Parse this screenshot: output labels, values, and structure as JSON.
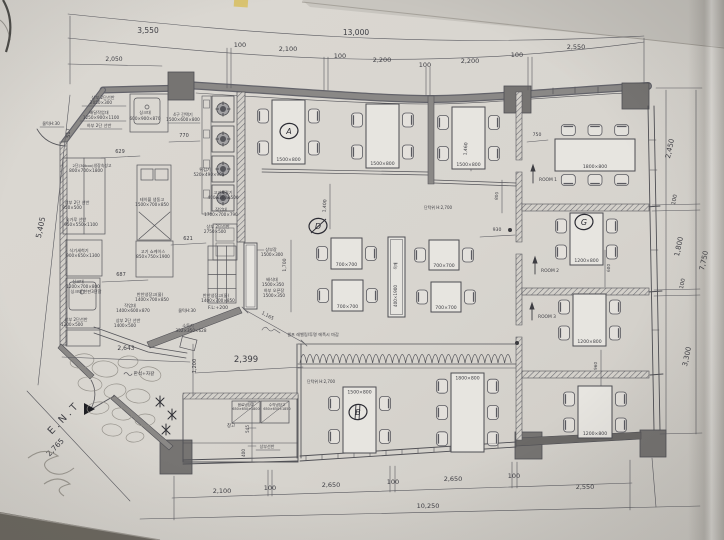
{
  "photo": {
    "paper_color": "#d8d5cf",
    "line_color": "#4f4f54",
    "wall_fill": "#8a8886",
    "column_fill": "#767472",
    "pen_color": "#2c2c34",
    "tape_color": "#d8c165"
  },
  "texts": [
    {
      "t": "3,550",
      "x": 148,
      "y": 33,
      "s": 7.5,
      "n": "dim-top-3550"
    },
    {
      "t": "13,000",
      "x": 356,
      "y": 35,
      "s": 7.5,
      "n": "dim-top-13000"
    },
    {
      "t": "2,050",
      "x": 114,
      "y": 61,
      "s": 6,
      "n": "dim-top-2050"
    },
    {
      "t": "100",
      "x": 240,
      "y": 47,
      "s": 6.5,
      "n": "dim-top-100a"
    },
    {
      "t": "2,100",
      "x": 288,
      "y": 51,
      "s": 6.5,
      "n": "dim-top-2100"
    },
    {
      "t": "100",
      "x": 340,
      "y": 58,
      "s": 6.5,
      "n": "dim-top-100b"
    },
    {
      "t": "2,200",
      "x": 382,
      "y": 62,
      "s": 6.5,
      "n": "dim-top-2200a"
    },
    {
      "t": "100",
      "x": 425,
      "y": 67,
      "s": 6.5,
      "n": "dim-top-100c"
    },
    {
      "t": "2,200",
      "x": 470,
      "y": 63,
      "s": 6.5,
      "n": "dim-top-2200b"
    },
    {
      "t": "100",
      "x": 517,
      "y": 57,
      "s": 6.5,
      "n": "dim-top-100d"
    },
    {
      "t": "2,550",
      "x": 576,
      "y": 49,
      "s": 6.5,
      "n": "dim-top-2550"
    },
    {
      "t": "5,405",
      "x": 43,
      "y": 228,
      "r": -78,
      "s": 7.5,
      "n": "dim-left-5405"
    },
    {
      "t": "2,765",
      "x": 57,
      "y": 449,
      "r": -46,
      "s": 7.5,
      "n": "dim-entry-2765"
    },
    {
      "t": "517",
      "x": 70,
      "y": 133,
      "r": -90,
      "s": 5,
      "n": "dim-517"
    },
    {
      "t": "2,100",
      "x": 222,
      "y": 493,
      "s": 6.5,
      "n": "dim-bot-2100"
    },
    {
      "t": "100",
      "x": 270,
      "y": 490,
      "s": 6.5,
      "n": "dim-bot-100a"
    },
    {
      "t": "2,650",
      "x": 331,
      "y": 487,
      "s": 6.5,
      "n": "dim-bot-2650a"
    },
    {
      "t": "100",
      "x": 393,
      "y": 484,
      "s": 6.5,
      "n": "dim-bot-100b"
    },
    {
      "t": "2,650",
      "x": 453,
      "y": 481,
      "s": 6.5,
      "n": "dim-bot-2650b"
    },
    {
      "t": "100",
      "x": 514,
      "y": 478,
      "s": 6.5,
      "n": "dim-bot-100c"
    },
    {
      "t": "2,550",
      "x": 585,
      "y": 489,
      "s": 6.5,
      "n": "dim-bot-2550"
    },
    {
      "t": "10,250",
      "x": 428,
      "y": 508,
      "s": 6.5,
      "n": "dim-bot-10250"
    },
    {
      "t": "2,450",
      "x": 672,
      "y": 149,
      "r": -78,
      "s": 7,
      "n": "dim-right-2450"
    },
    {
      "t": "100",
      "x": 676,
      "y": 200,
      "r": -78,
      "s": 5.5,
      "n": "dim-right-100a"
    },
    {
      "t": "1,800",
      "x": 681,
      "y": 247,
      "r": -78,
      "s": 7,
      "n": "dim-right-1800"
    },
    {
      "t": "100",
      "x": 684,
      "y": 284,
      "r": -78,
      "s": 5.5,
      "n": "dim-right-100b"
    },
    {
      "t": "3,300",
      "x": 689,
      "y": 357,
      "r": -78,
      "s": 7,
      "n": "dim-right-3300"
    },
    {
      "t": "7,750",
      "x": 706,
      "y": 261,
      "r": -78,
      "s": 7,
      "n": "dim-right-7750"
    },
    {
      "t": "629",
      "x": 120,
      "y": 153,
      "s": 5,
      "n": "dim-629"
    },
    {
      "t": "770",
      "x": 184,
      "y": 137,
      "s": 5,
      "n": "dim-770"
    },
    {
      "t": "687",
      "x": 121,
      "y": 276,
      "s": 5,
      "n": "dim-687"
    },
    {
      "t": "621",
      "x": 188,
      "y": 240,
      "s": 5,
      "n": "dim-621"
    },
    {
      "t": "1,460",
      "x": 467,
      "y": 149,
      "r": -86,
      "s": 4.6,
      "n": "dim-1460"
    },
    {
      "t": "800",
      "x": 498,
      "y": 196,
      "r": -86,
      "s": 4.2,
      "n": "dim-800"
    },
    {
      "t": "1,400",
      "x": 326,
      "y": 206,
      "r": -86,
      "s": 4.6,
      "n": "dim-1400"
    },
    {
      "t": "1,700",
      "x": 286,
      "y": 265,
      "r": -90,
      "s": 4.6,
      "n": "dim-1700"
    },
    {
      "t": "930",
      "x": 497,
      "y": 231,
      "s": 4.6,
      "n": "dim-930"
    },
    {
      "t": "600",
      "x": 610,
      "y": 268,
      "r": -88,
      "s": 4.2,
      "n": "dim-600"
    },
    {
      "t": "960",
      "x": 597,
      "y": 366,
      "r": -88,
      "s": 4.2,
      "n": "dim-960"
    },
    {
      "t": "750",
      "x": 537,
      "y": 136,
      "s": 4.6,
      "n": "dim-750"
    },
    {
      "t": "545",
      "x": 249,
      "y": 429,
      "r": -90,
      "s": 4.2,
      "n": "dim-545"
    },
    {
      "t": "400",
      "x": 245,
      "y": 453,
      "r": -90,
      "s": 4.2,
      "n": "dim-400"
    },
    {
      "t": "1,200",
      "x": 196,
      "y": 366,
      "r": -90,
      "s": 5,
      "n": "dim-1200"
    },
    {
      "t": "2,399",
      "x": 246,
      "y": 362,
      "s": 8.5,
      "n": "dim-2399"
    },
    {
      "t": "2,643",
      "x": 126,
      "y": 350,
      "s": 6,
      "n": "dim-2643"
    },
    {
      "t": "1,165",
      "x": 267,
      "y": 317,
      "r": 29,
      "s": 4.6,
      "n": "dim-1165"
    },
    {
      "t": "상부 2단선반",
      "x": 103,
      "y": 99,
      "n": "label-shelf-upper2"
    },
    {
      "t": "2050×300",
      "x": 101,
      "y": 104,
      "n": "label-shelf-upper2-size"
    },
    {
      "t": "배달작업대",
      "x": 99,
      "y": 114,
      "n": "label-delivery-worktable"
    },
    {
      "t": "1250×900×1100",
      "x": 101,
      "y": 119,
      "n": "label-delivery-worktable-size"
    },
    {
      "t": "하부 2단 선반",
      "x": 99,
      "y": 127,
      "n": "label-shelf-lower2"
    },
    {
      "t": "싱크대",
      "x": 145,
      "y": 114,
      "n": "label-sink-top"
    },
    {
      "t": "600×900×870",
      "x": 145,
      "y": 120,
      "n": "label-sink-top-size"
    },
    {
      "t": "4구 간택기",
      "x": 183,
      "y": 116,
      "n": "label-4burner"
    },
    {
      "t": "1500×600×800",
      "x": 183,
      "y": 121,
      "n": "label-4burner-size"
    },
    {
      "t": "2단(30box)냉장숙성고",
      "x": 92,
      "y": 167,
      "s": 3.9,
      "n": "label-aging-fridge"
    },
    {
      "t": "800×700×1800",
      "x": 86,
      "y": 172,
      "n": "label-aging-fridge-size"
    },
    {
      "t": "상부 2단 선반",
      "x": 77,
      "y": 204,
      "n": "label-shelf-950"
    },
    {
      "t": "950×500",
      "x": 72,
      "y": 209,
      "n": "label-shelf-950-size"
    },
    {
      "t": "숯가루 선반",
      "x": 76,
      "y": 221,
      "n": "label-charcoal-shelf"
    },
    {
      "t": "950×550×1100",
      "x": 81,
      "y": 226,
      "n": "label-charcoal-shelf-size"
    },
    {
      "t": "식기세척기",
      "x": 79,
      "y": 252,
      "n": "label-dishwasher"
    },
    {
      "t": "900×650×1300",
      "x": 83,
      "y": 257,
      "n": "label-dishwasher-size"
    },
    {
      "t": "테이블 냉동고",
      "x": 152,
      "y": 201,
      "n": "label-table-freezer"
    },
    {
      "t": "1500×700×850",
      "x": 152,
      "y": 206,
      "n": "label-table-freezer-size"
    },
    {
      "t": "고기 쇼케이스",
      "x": 153,
      "y": 253,
      "n": "label-meat-showcase"
    },
    {
      "t": "850×750×1900",
      "x": 153,
      "y": 258,
      "n": "label-meat-showcase-size"
    },
    {
      "t": "싱크대",
      "x": 78,
      "y": 283,
      "n": "label-sink-left"
    },
    {
      "t": "1200×700×800",
      "x": 83,
      "y": 288,
      "n": "label-sink-left-size"
    },
    {
      "t": "싱크대 천판3단함",
      "x": 86,
      "y": 293,
      "n": "label-sink-left-note"
    },
    {
      "t": "상부 2단선반",
      "x": 76,
      "y": 321,
      "n": "label-shelf-1200"
    },
    {
      "t": "1200×500",
      "x": 72,
      "y": 326,
      "n": "label-shelf-1200-size"
    },
    {
      "t": "작업대",
      "x": 130,
      "y": 307,
      "n": "label-worktable-1400"
    },
    {
      "t": "1400×600×870",
      "x": 133,
      "y": 312,
      "n": "label-worktable-1400-size"
    },
    {
      "t": "상부 2단 선반",
      "x": 128,
      "y": 322,
      "n": "label-shelf-1400"
    },
    {
      "t": "1400×500",
      "x": 125,
      "y": 327,
      "n": "label-shelf-1400-size"
    },
    {
      "t": "소독기",
      "x": 188,
      "y": 327,
      "n": "label-sterilizer"
    },
    {
      "t": "352×350×628",
      "x": 191,
      "y": 332,
      "n": "label-sterilizer-size"
    },
    {
      "t": "튀김기",
      "x": 205,
      "y": 171,
      "n": "label-fryer"
    },
    {
      "t": "520×490×905",
      "x": 209,
      "y": 176,
      "n": "label-fryer-size"
    },
    {
      "t": "고기세절기",
      "x": 223,
      "y": 194,
      "n": "label-meat-cutter"
    },
    {
      "t": "400×360×500",
      "x": 223,
      "y": 199,
      "n": "label-meat-cutter-size"
    },
    {
      "t": "작업대",
      "x": 221,
      "y": 211,
      "n": "label-worktable-1700"
    },
    {
      "t": "1700×700×790",
      "x": 221,
      "y": 216,
      "n": "label-worktable-1700-size"
    },
    {
      "t": "상부 2단선반",
      "x": 218,
      "y": 228,
      "n": "label-shelf-2750"
    },
    {
      "t": "2750×500",
      "x": 215,
      "y": 233,
      "n": "label-shelf-2750-size"
    },
    {
      "t": "상부장",
      "x": 271,
      "y": 251,
      "n": "label-upper-cabinet"
    },
    {
      "t": "1500×300",
      "x": 272,
      "y": 256,
      "n": "label-upper-cabinet-size"
    },
    {
      "t": "배식대",
      "x": 272,
      "y": 281,
      "n": "label-serving-counter"
    },
    {
      "t": "1500×350",
      "x": 273,
      "y": 286,
      "n": "label-serving-counter-size"
    },
    {
      "t": "하부 오픈장",
      "x": 274,
      "y": 292,
      "n": "label-open-cabinet"
    },
    {
      "t": "1500×350",
      "x": 274,
      "y": 297,
      "n": "label-open-cabinet-size"
    },
    {
      "t": "반찬냉장고(물)",
      "x": 150,
      "y": 296,
      "n": "label-side-fridge-a"
    },
    {
      "t": "1400×700×850",
      "x": 152,
      "y": 301,
      "n": "label-side-fridge-a-size"
    },
    {
      "t": "반찬냉장고(물)",
      "x": 216,
      "y": 297,
      "n": "label-side-fridge-b"
    },
    {
      "t": "1400×700×850",
      "x": 218,
      "y": 302,
      "n": "label-side-fridge-b-size"
    },
    {
      "t": "음료냉장고",
      "x": 246,
      "y": 406,
      "s": 3.6,
      "n": "label-drink-fridge"
    },
    {
      "t": "650×650×1800",
      "x": 246,
      "y": 410,
      "s": 3.4,
      "n": "label-drink-fridge-size"
    },
    {
      "t": "수직냉장고",
      "x": 277,
      "y": 406,
      "s": 3.6,
      "n": "label-upright-fridge"
    },
    {
      "t": "650×650×1850",
      "x": 277,
      "y": 410,
      "s": 3.4,
      "n": "label-upright-fridge-size"
    },
    {
      "t": "창고",
      "x": 231,
      "y": 427,
      "s": 4.4,
      "n": "label-storage"
    },
    {
      "t": "상부선반",
      "x": 267,
      "y": 448,
      "s": 4,
      "n": "label-storage-shelf"
    },
    {
      "t": "물턱H:30",
      "x": 51,
      "y": 125,
      "s": 4.2,
      "n": "label-sill-a"
    },
    {
      "t": "물턱H:30",
      "x": 187,
      "y": 312,
      "s": 4.2,
      "n": "label-sill-b"
    },
    {
      "t": "F.L:+200",
      "x": 218,
      "y": 309,
      "s": 4.6,
      "n": "label-floor-level"
    },
    {
      "t": "판석+자갈",
      "x": 144,
      "y": 375,
      "s": 4.6,
      "n": "label-flagstone-gravel"
    },
    {
      "t": "단턱위 H:2,700",
      "x": 438,
      "y": 209,
      "s": 4,
      "n": "label-step-height-a"
    },
    {
      "t": "단턱위 H:2,700",
      "x": 321,
      "y": 383,
      "s": 4,
      "n": "label-step-height-b"
    },
    {
      "t": "셀프 레벨링/투명 에폭시 마감",
      "x": 313,
      "y": 336,
      "s": 4.2,
      "n": "label-epoxy-finish"
    },
    {
      "t": "E.N.T",
      "x": 66,
      "y": 420,
      "r": -46,
      "s": 10,
      "ls": 3,
      "n": "label-entrance"
    },
    {
      "t": "ROOM 1",
      "x": 548,
      "y": 181,
      "s": 4.4,
      "n": "label-room1"
    },
    {
      "t": "ROOM 2",
      "x": 550,
      "y": 272,
      "s": 4.4,
      "n": "label-room2"
    },
    {
      "t": "ROOM 3",
      "x": 547,
      "y": 318,
      "s": 4.4,
      "n": "label-room3"
    },
    {
      "t": "400×1900",
      "x": 397,
      "y": 296,
      "r": -90,
      "s": 4.2,
      "n": "label-partition-size"
    },
    {
      "t": "목재",
      "x": 397,
      "y": 266,
      "r": -90,
      "s": 3.8,
      "n": "label-partition-wood"
    }
  ],
  "tables": [
    {
      "label": "1500×800",
      "x": 272,
      "y": 100,
      "w": 33,
      "h": 64,
      "chairs": {
        "left": 2,
        "right": 2
      }
    },
    {
      "label": "1500×800",
      "x": 366,
      "y": 104,
      "w": 33,
      "h": 64,
      "chairs": {
        "left": 2,
        "right": 2
      }
    },
    {
      "label": "1500×800",
      "x": 452,
      "y": 107,
      "w": 33,
      "h": 62,
      "chairs": {
        "left": 2,
        "right": 2
      }
    },
    {
      "label": "1800×800",
      "x": 555,
      "y": 139,
      "w": 80,
      "h": 32,
      "chairs": {
        "top": 3,
        "bottom": 3
      }
    },
    {
      "label": "1200×800",
      "x": 570,
      "y": 213,
      "w": 33,
      "h": 52,
      "chairs": {
        "left": 2,
        "right": 2
      }
    },
    {
      "label": "1200×800",
      "x": 573,
      "y": 294,
      "w": 33,
      "h": 52,
      "chairs": {
        "left": 2,
        "right": 2
      }
    },
    {
      "label": "1200×800",
      "x": 578,
      "y": 386,
      "w": 34,
      "h": 52,
      "chairs": {
        "left": 2,
        "right": 2
      }
    },
    {
      "label": "1500×800",
      "x": 343,
      "y": 387,
      "w": 33,
      "h": 66,
      "chairs": {
        "left": 2,
        "right": 2
      },
      "labelPos": "top"
    },
    {
      "label": "1800×800",
      "x": 451,
      "y": 373,
      "w": 33,
      "h": 79,
      "chairs": {
        "left": 3,
        "right": 3
      },
      "labelPos": "top"
    },
    {
      "label": "700×700",
      "x": 331,
      "y": 238,
      "w": 31,
      "h": 31,
      "chairs": {
        "left": 1,
        "right": 1
      }
    },
    {
      "label": "700×700",
      "x": 332,
      "y": 280,
      "w": 31,
      "h": 31,
      "chairs": {
        "left": 1,
        "right": 1
      }
    },
    {
      "label": "700×700",
      "x": 429,
      "y": 240,
      "w": 30,
      "h": 30,
      "chairs": {
        "left": 1,
        "right": 1
      }
    },
    {
      "label": "700×700",
      "x": 431,
      "y": 282,
      "w": 30,
      "h": 30,
      "chairs": {
        "left": 1,
        "right": 1
      }
    }
  ],
  "stoves": [
    {
      "x": 212,
      "y": 96
    },
    {
      "x": 212,
      "y": 126
    },
    {
      "x": 212,
      "y": 156
    },
    {
      "x": 212,
      "y": 185
    }
  ],
  "marks": [
    {
      "letter": "A",
      "x": 289,
      "y": 131
    },
    {
      "letter": "D",
      "x": 318,
      "y": 226
    },
    {
      "letter": "B",
      "x": 358,
      "y": 412
    },
    {
      "letter": "G",
      "x": 584,
      "y": 222
    }
  ]
}
